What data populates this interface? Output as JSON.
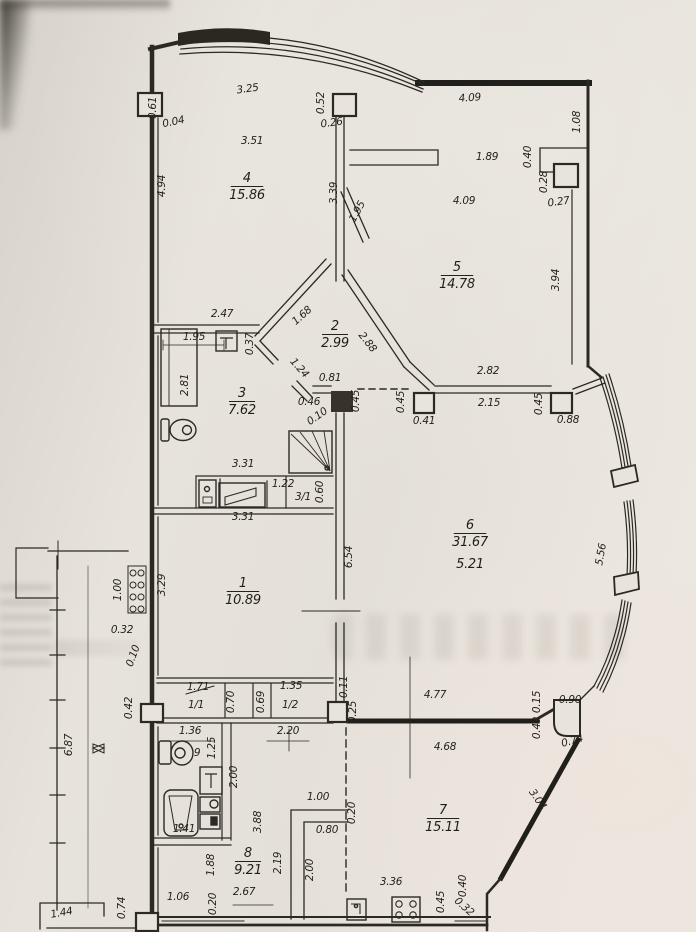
{
  "document": {
    "kind": "scanned apartment floor plan",
    "paper_color": "#e6e2db",
    "ink_color": "#2c2923"
  },
  "rooms": [
    {
      "number": "4",
      "area": "15.86",
      "x": 247,
      "y": 182
    },
    {
      "number": "5",
      "area": "14.78",
      "x": 457,
      "y": 271
    },
    {
      "number": "2",
      "area": "2.99",
      "x": 335,
      "y": 330
    },
    {
      "number": "3",
      "area": "7.62",
      "x": 242,
      "y": 397
    },
    {
      "number": "1",
      "area": "10.89",
      "x": 243,
      "y": 587
    },
    {
      "number": "6",
      "area": "31.67",
      "area2": "5.21",
      "x": 470,
      "y": 529
    },
    {
      "number": "7",
      "area": "15.11",
      "x": 443,
      "y": 814
    },
    {
      "number": "8",
      "area": "9.21",
      "x": 248,
      "y": 857
    }
  ],
  "labels": [
    {
      "t": "3.25",
      "x": 248,
      "y": 92,
      "r": -8
    },
    {
      "t": "0.61",
      "x": 156,
      "y": 108,
      "r": -90
    },
    {
      "t": "0.04",
      "x": 174,
      "y": 125,
      "r": -12
    },
    {
      "t": "3.51",
      "x": 252,
      "y": 144
    },
    {
      "t": "4.94",
      "x": 165,
      "y": 186,
      "r": -90
    },
    {
      "t": "0.52",
      "x": 324,
      "y": 103,
      "r": -90
    },
    {
      "t": "0.26",
      "x": 332,
      "y": 126,
      "r": -8
    },
    {
      "t": "3.39",
      "x": 337,
      "y": 193,
      "r": -90
    },
    {
      "t": "1.95",
      "x": 360,
      "y": 213,
      "r": -62
    },
    {
      "t": "2.47",
      "x": 222,
      "y": 317
    },
    {
      "t": "4.09",
      "x": 470,
      "y": 101,
      "r": -4
    },
    {
      "t": "1.08",
      "x": 580,
      "y": 122,
      "r": -90
    },
    {
      "t": "1.89",
      "x": 487,
      "y": 160
    },
    {
      "t": "0.40",
      "x": 531,
      "y": 157,
      "r": -90
    },
    {
      "t": "4.09",
      "x": 464,
      "y": 204
    },
    {
      "t": "0.28",
      "x": 547,
      "y": 182,
      "r": -90
    },
    {
      "t": "0.27",
      "x": 559,
      "y": 205,
      "r": -8
    },
    {
      "t": "3.94",
      "x": 559,
      "y": 280,
      "r": -90
    },
    {
      "t": "1.68",
      "x": 304,
      "y": 318,
      "r": -42
    },
    {
      "t": "2.88",
      "x": 365,
      "y": 344,
      "r": 52
    },
    {
      "t": "1.24",
      "x": 297,
      "y": 370,
      "r": 48
    },
    {
      "t": "0.37",
      "x": 253,
      "y": 344,
      "r": -90
    },
    {
      "t": "1.95",
      "x": 194,
      "y": 340
    },
    {
      "t": "2.81",
      "x": 188,
      "y": 385,
      "r": -90
    },
    {
      "t": "0.81",
      "x": 330,
      "y": 381
    },
    {
      "t": "0.46",
      "x": 309,
      "y": 405
    },
    {
      "t": "0.10",
      "x": 319,
      "y": 419,
      "r": -35
    },
    {
      "t": "0.45",
      "x": 359,
      "y": 401,
      "r": -90
    },
    {
      "t": "0.45",
      "x": 404,
      "y": 402,
      "r": -90
    },
    {
      "t": "0.41",
      "x": 424,
      "y": 424
    },
    {
      "t": "2.82",
      "x": 488,
      "y": 374
    },
    {
      "t": "2.15",
      "x": 489,
      "y": 406
    },
    {
      "t": "0.45",
      "x": 542,
      "y": 404,
      "r": -90
    },
    {
      "t": "0.88",
      "x": 568,
      "y": 423
    },
    {
      "t": "3.31",
      "x": 243,
      "y": 467
    },
    {
      "t": "1.22",
      "x": 283,
      "y": 487
    },
    {
      "t": "0.60",
      "x": 323,
      "y": 492,
      "r": -90
    },
    {
      "t": "3/1",
      "x": 303,
      "y": 500,
      "s": 12
    },
    {
      "t": "3.31",
      "x": 243,
      "y": 520
    },
    {
      "t": "6.54",
      "x": 352,
      "y": 557,
      "r": -90
    },
    {
      "t": "5.56",
      "x": 604,
      "y": 555,
      "r": -80
    },
    {
      "t": "3.29",
      "x": 165,
      "y": 585,
      "r": -90
    },
    {
      "t": "1.00",
      "x": 121,
      "y": 590,
      "r": -90
    },
    {
      "t": "0.32",
      "x": 122,
      "y": 633
    },
    {
      "t": "0.10",
      "x": 136,
      "y": 657,
      "r": -70
    },
    {
      "t": "0.42",
      "x": 132,
      "y": 708,
      "r": -90
    },
    {
      "t": "1.71",
      "x": 198,
      "y": 690
    },
    {
      "t": "1/1",
      "x": 196,
      "y": 708,
      "s": 11
    },
    {
      "t": "0.70",
      "x": 234,
      "y": 702,
      "r": -90
    },
    {
      "t": "0.69",
      "x": 264,
      "y": 702,
      "r": -90
    },
    {
      "t": "1.35",
      "x": 291,
      "y": 689
    },
    {
      "t": "1/2",
      "x": 290,
      "y": 708,
      "s": 11
    },
    {
      "t": "0.11",
      "x": 347,
      "y": 687,
      "r": -90
    },
    {
      "t": "0.25",
      "x": 356,
      "y": 712,
      "r": -90
    },
    {
      "t": "4.77",
      "x": 435,
      "y": 698
    },
    {
      "t": "0.90",
      "x": 570,
      "y": 703
    },
    {
      "t": "0.15",
      "x": 540,
      "y": 702,
      "r": -90
    },
    {
      "t": "0.49",
      "x": 540,
      "y": 728,
      "r": -90
    },
    {
      "t": "0.74",
      "x": 573,
      "y": 744,
      "r": -15
    },
    {
      "t": "2.20",
      "x": 288,
      "y": 734
    },
    {
      "t": "1.36",
      "x": 190,
      "y": 734
    },
    {
      "t": "9",
      "x": 197,
      "y": 756,
      "s": 13
    },
    {
      "t": "1.25",
      "x": 215,
      "y": 748,
      "r": -90
    },
    {
      "t": "2.00",
      "x": 237,
      "y": 777,
      "r": -90
    },
    {
      "t": "1.41",
      "x": 184,
      "y": 832
    },
    {
      "t": "6.87",
      "x": 72,
      "y": 745,
      "r": -90
    },
    {
      "t": "4.68",
      "x": 445,
      "y": 750
    },
    {
      "t": "3.04",
      "x": 535,
      "y": 801,
      "r": 55
    },
    {
      "t": "1.00",
      "x": 318,
      "y": 800
    },
    {
      "t": "0.20",
      "x": 355,
      "y": 813,
      "r": -90
    },
    {
      "t": "0.80",
      "x": 327,
      "y": 833
    },
    {
      "t": "2.00",
      "x": 313,
      "y": 870,
      "r": -90
    },
    {
      "t": "3.36",
      "x": 391,
      "y": 885
    },
    {
      "t": "0.45",
      "x": 444,
      "y": 902,
      "r": -90
    },
    {
      "t": "0.40",
      "x": 466,
      "y": 886,
      "r": -90
    },
    {
      "t": "0.32",
      "x": 462,
      "y": 909,
      "r": 42
    },
    {
      "t": "1.88",
      "x": 214,
      "y": 865,
      "r": -90
    },
    {
      "t": "3.88",
      "x": 261,
      "y": 822,
      "r": -90
    },
    {
      "t": "2.19",
      "x": 281,
      "y": 863,
      "r": -90
    },
    {
      "t": "2.67",
      "x": 244,
      "y": 895
    },
    {
      "t": "1.06",
      "x": 178,
      "y": 900
    },
    {
      "t": "0.20",
      "x": 216,
      "y": 904,
      "r": -90
    },
    {
      "t": "0.74",
      "x": 125,
      "y": 908,
      "r": -90
    },
    {
      "t": "1.44",
      "x": 62,
      "y": 916,
      "r": -10
    }
  ],
  "fixtures": [
    "toilet-icon",
    "shower-icon",
    "wardrobe-icon",
    "vent-box-icon",
    "washbasin-icon",
    "counter-icon",
    "radiator-icon",
    "bathtub-icon",
    "washing-machine-icon",
    "kitchen-sink-icon",
    "stove-icon",
    "damper-icon"
  ]
}
